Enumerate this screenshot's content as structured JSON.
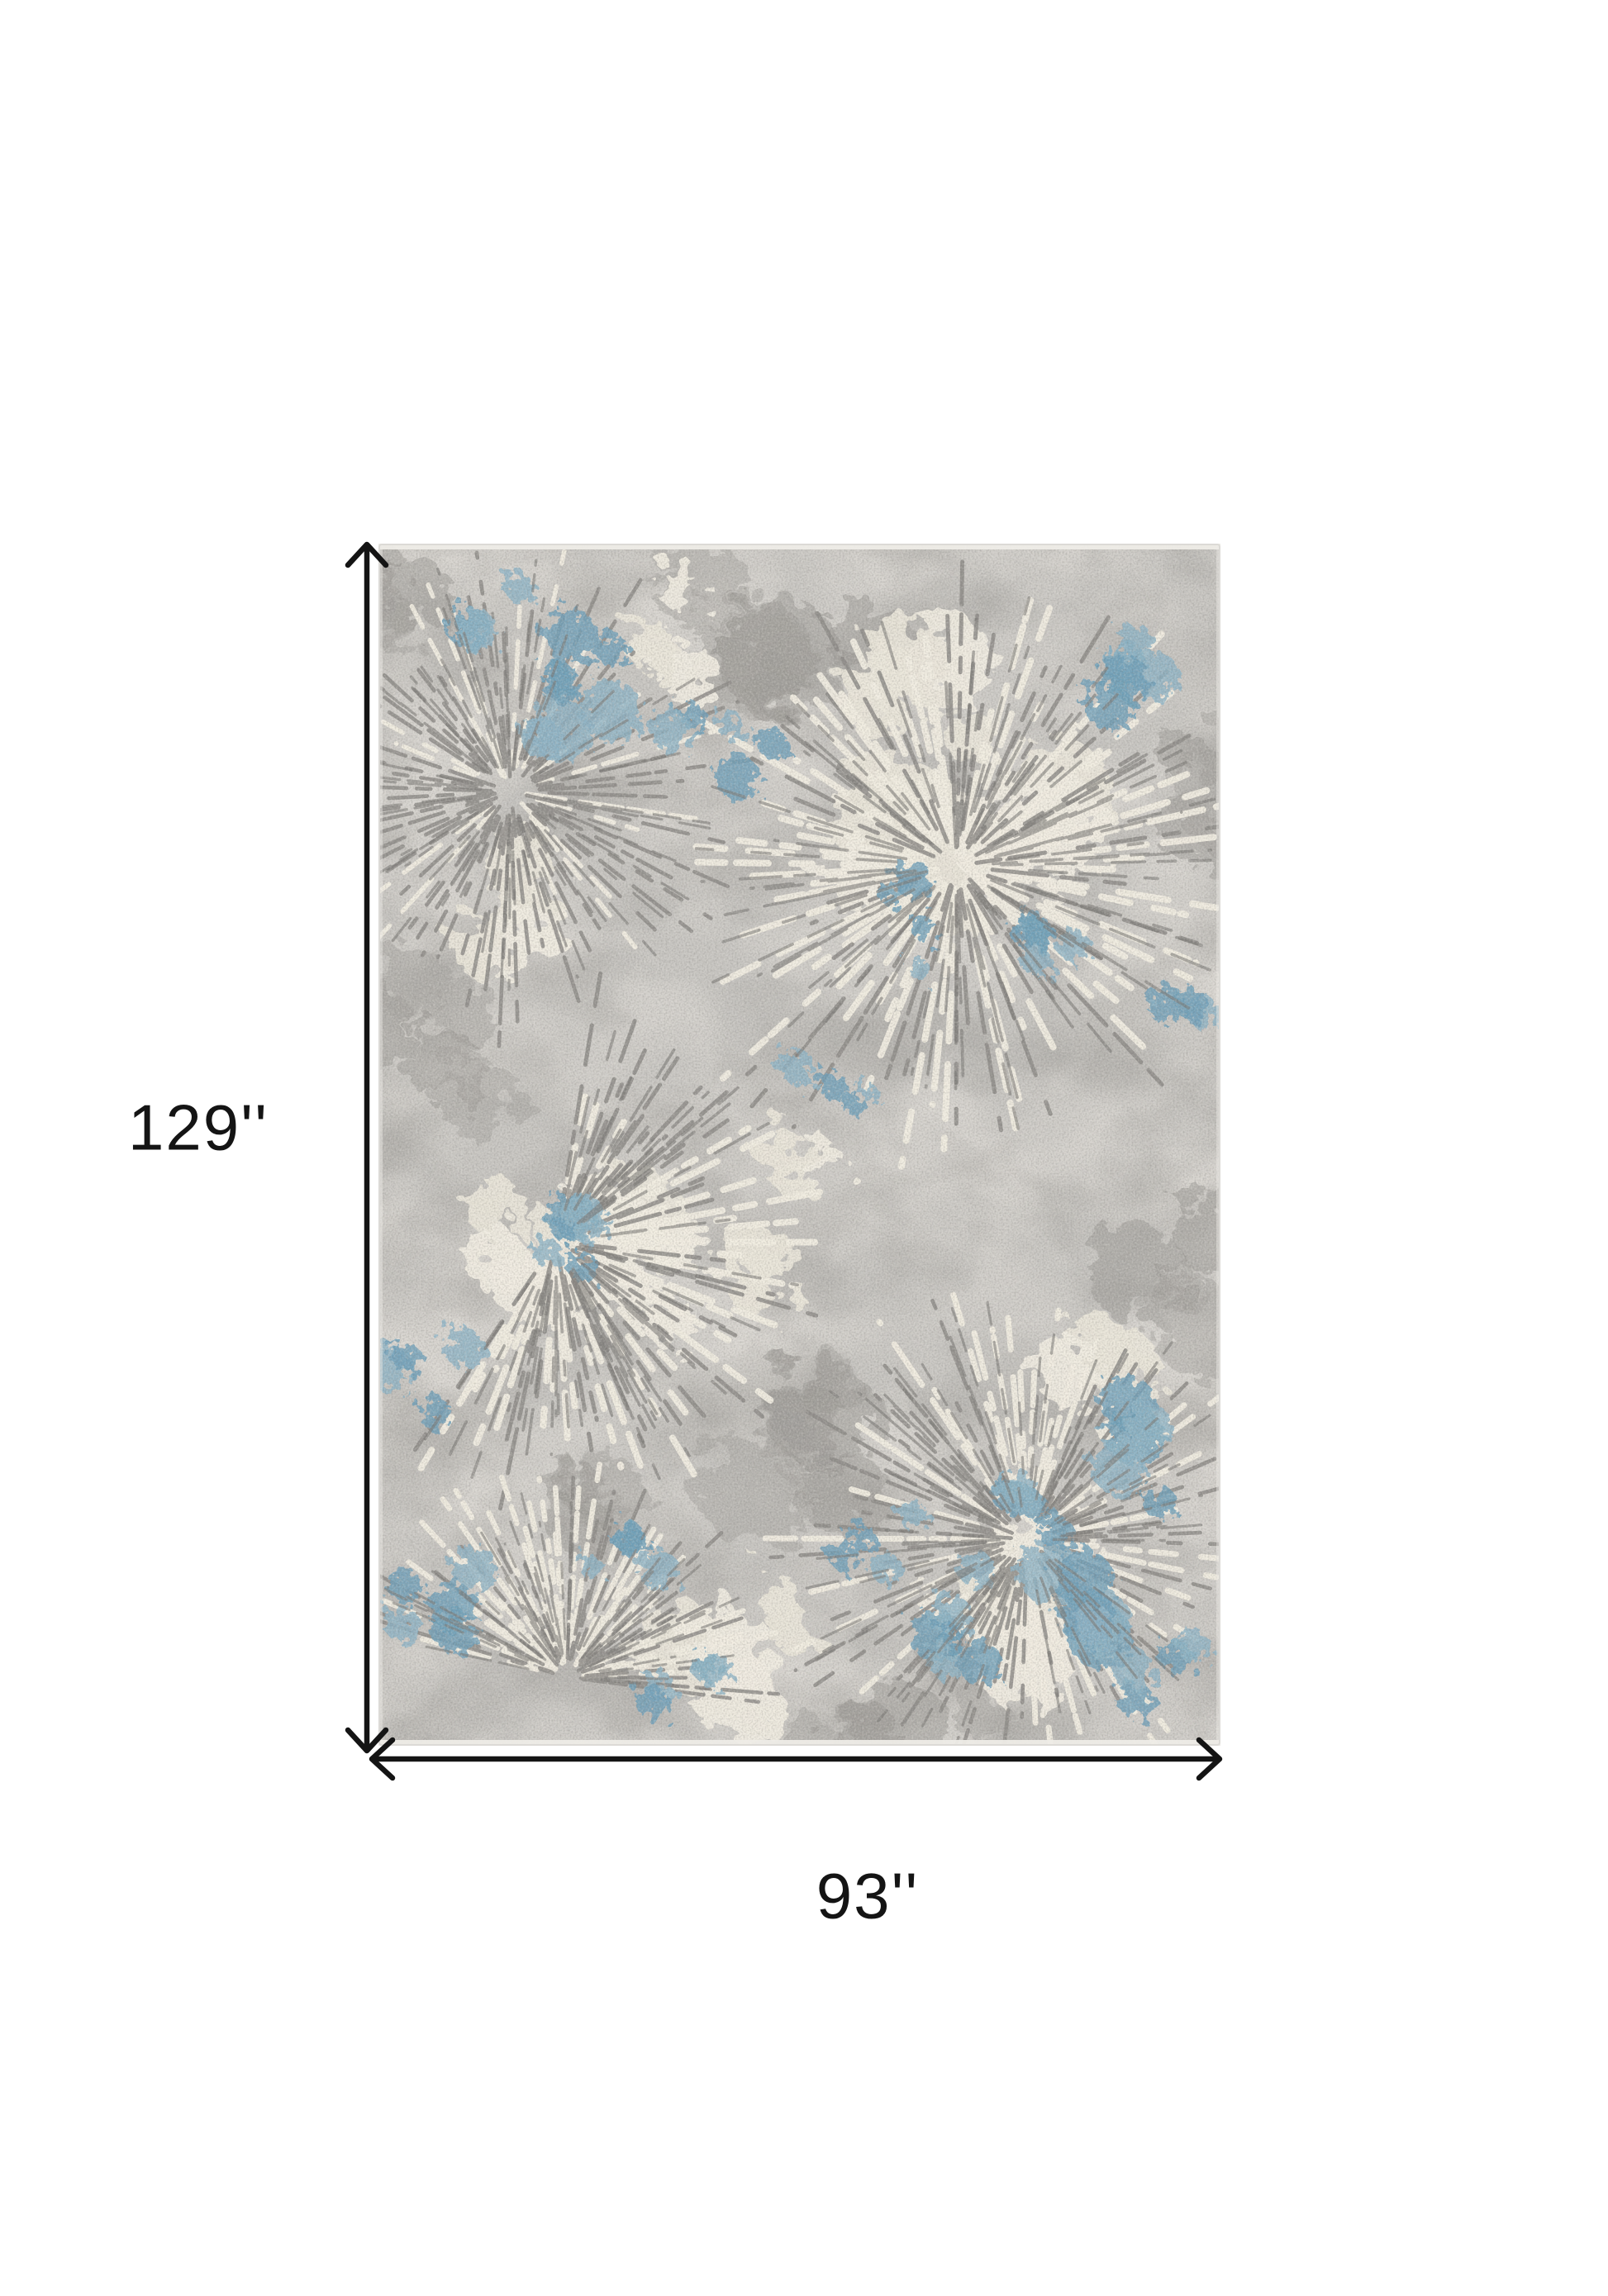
{
  "annotations": {
    "height_label": "129''",
    "width_label": "93''",
    "arrow_color": "#141414"
  },
  "page": {
    "background": "#ffffff"
  },
  "rug": {
    "colors": {
      "base": "#c8c6c2",
      "light_blotch": "#dbd8d3",
      "dark_blotch": "#a8a6a2",
      "ray_gray": "#8d8b87",
      "ray_gray_dark": "#7c7a76",
      "ivory": "#ece7db",
      "ivory_bright": "#f2eee3",
      "blue": "#6fa0ba",
      "blue_light": "#8db3c6",
      "selvedge": "#eeece7",
      "edge_line": "#dcdad6",
      "grain_dark": "#72706c",
      "grain_light": "#f4f1ea"
    }
  }
}
